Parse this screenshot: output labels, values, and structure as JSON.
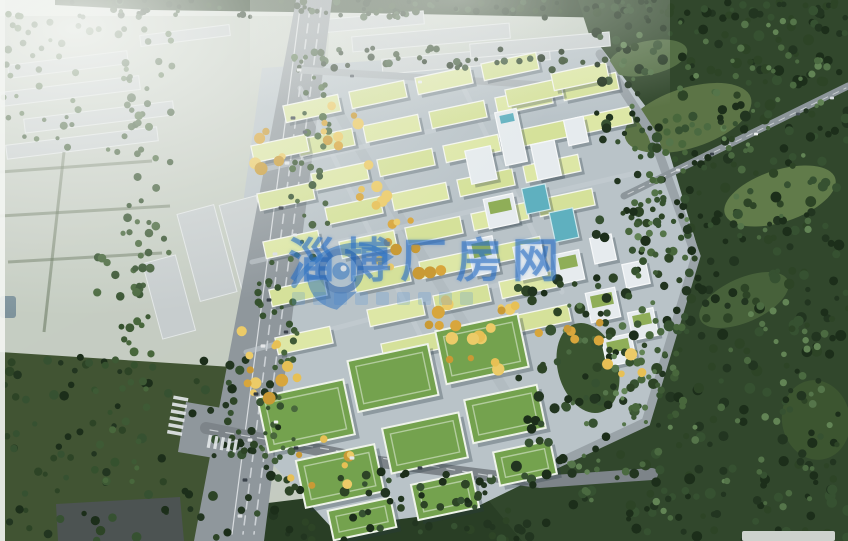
{
  "image": {
    "description": "Aerial bird's-eye rendering of an eco industrial park: rows of white multi-storey factory buildings with pale yellow-green and grass-green roofs, a tree-lined highway on the left, grey factory sheds and hazy fields at the top-left, and dense dark forest on the right and bottom, with a central avenue of autumn-yellow trees.",
    "width": 848,
    "height": 541
  },
  "watermark": {
    "text": "淄博厂房网",
    "tagline_blocks": 9,
    "text_color": "rgba(40,110,195,0.55)",
    "logo": "aperture-swoosh-icon",
    "logo_color": "#2a6fc0"
  },
  "palette": {
    "haze_white": "#f4f6f3",
    "field_grey_green": "#c5ccc2",
    "forest_dark": "#31472c",
    "lawn_dark": "#415433",
    "park_ground": "#b9c3c8",
    "pale_roof": "#dde7a6",
    "green_roof": "#74a24e",
    "road_grey": "#8f979c",
    "teal_glass": "#5fb0bf",
    "autumn_yellow": "#e7c055",
    "watermark_blue": "#2a6fc0"
  },
  "scene": {
    "shadow": "rgba(40,55,65,0.30)",
    "palettes": {
      "dark": [
        "#223520",
        "#2d4426",
        "#365131",
        "#1c2e1a"
      ],
      "mid": [
        "#3e5a35",
        "#48673c",
        "#35512e"
      ],
      "light": [
        "#55754a",
        "#628455",
        "#4b6a41"
      ],
      "yellow": [
        "#d8a63c",
        "#e7c055",
        "#c99a35",
        "#eccb68"
      ]
    },
    "polygons": [
      {
        "name": "fields-top-left",
        "pts": "0,16 330,16 304,541 0,541",
        "fill": "#c5ccc2",
        "op": 0.95
      },
      {
        "name": "top-tree-strip",
        "pts": "55,0 848,0 848,13 620,18 360,13 150,10 55,5",
        "fill": "#2b3f27",
        "op": 1
      },
      {
        "name": "lawn-bottom-left",
        "pts": "0,352 248,368 258,541 0,541",
        "fill": "#415433",
        "op": 1
      },
      {
        "name": "dark-building-bottom-left",
        "pts": "56,504 180,497 184,541 58,541",
        "fill": "#4c5352",
        "op": 1
      },
      {
        "name": "forest-right",
        "pts": "578,0 848,0 848,541 514,541 468,502 556,458 640,422 698,256 648,146 596,56",
        "fill": "#31472c",
        "op": 1
      },
      {
        "name": "forest-bottom",
        "pts": "244,506 470,478 522,541 244,541",
        "fill": "#293e25",
        "op": 1
      },
      {
        "name": "park-ground",
        "pts": "262,68 600,46 662,128 700,256 646,424 556,468 470,510 332,528 252,442 244,196",
        "fill": "#b9c3c8",
        "op": 1
      }
    ],
    "clearings": [
      [
        688,
        118,
        66,
        30,
        -18,
        "#5c7446"
      ],
      [
        780,
        196,
        58,
        26,
        -18,
        "#617b4a"
      ],
      [
        648,
        58,
        40,
        17,
        -12,
        "#546e45"
      ],
      [
        744,
        300,
        48,
        22,
        -24,
        "#47613a"
      ],
      [
        816,
        420,
        34,
        40,
        -10,
        "#3c5530"
      ],
      [
        588,
        368,
        30,
        46,
        -16,
        "#3a5430"
      ]
    ],
    "sheds": {
      "fill": "#c7cdce",
      "stroke": "#e3e7e7",
      "items": [
        [
          8,
          58,
          120,
          13,
          -7
        ],
        [
          0,
          84,
          140,
          14,
          -7
        ],
        [
          24,
          110,
          150,
          14,
          -7
        ],
        [
          6,
          136,
          152,
          14,
          -7
        ],
        [
          140,
          30,
          90,
          11,
          -7
        ],
        [
          188,
          208,
          38,
          90,
          -15
        ],
        [
          230,
          199,
          38,
          88,
          -15
        ],
        [
          152,
          258,
          34,
          78,
          -15
        ],
        [
          306,
          16,
          118,
          13,
          -5
        ],
        [
          352,
          30,
          158,
          15,
          -5
        ],
        [
          382,
          52,
          168,
          15,
          -5
        ],
        [
          470,
          38,
          140,
          14,
          -5
        ]
      ]
    },
    "hedge_color": "#5e6e54",
    "hedges": [
      "M0,172 L152,161",
      "M0,216 L170,206",
      "M8,262 L162,253",
      "M64,152 L44,332"
    ],
    "pond": {
      "x": 0,
      "y": 296,
      "w": 16,
      "h": 22,
      "fill": "#7e939c"
    },
    "roads": [
      {
        "name": "highway",
        "pts": "296,0 332,0 264,541 194,541",
        "fill": "#8f979c"
      },
      {
        "name": "intersection-pad",
        "pts": "186,402 246,412 238,462 178,452",
        "fill": "#8f979c"
      },
      {
        "name": "highway-lane-line-1",
        "d": "M310,8 L243,534",
        "w": 1.6,
        "color": "#ccd1d5",
        "dash": "9 7"
      },
      {
        "name": "highway-lane-line-2",
        "d": "M321,8 L254,534",
        "w": 1.6,
        "color": "#ccd1d5",
        "dash": "9 7"
      },
      {
        "name": "highway-edge-line",
        "d": "M300,8 L232,534",
        "w": 1.2,
        "color": "#d8dcdf",
        "dash": ""
      },
      {
        "name": "park-top-road",
        "d": "M300,70 L622,90",
        "w": 7,
        "color": "#a9b1b5",
        "dash": ""
      },
      {
        "name": "park-perimeter-road",
        "d": "M600,54 L652,134 L696,256 L646,422 L556,464",
        "w": 9,
        "color": "#9aa3a8",
        "dash": ""
      },
      {
        "name": "bottom-road",
        "d": "M206,428 L380,462 L540,482 L652,474",
        "w": 12,
        "color": "#7d8489",
        "dash": ""
      },
      {
        "name": "bottom-road-line",
        "d": "M210,430 L540,484",
        "w": 1.2,
        "color": "#c5cacd",
        "dash": "8 8"
      },
      {
        "name": "forest-road",
        "d": "M624,196 L848,86",
        "w": 7,
        "color": "#8d969b",
        "dash": ""
      },
      {
        "name": "forest-road-line",
        "d": "M628,194 L846,88",
        "w": 1,
        "color": "#c8cdd0",
        "dash": "6 6"
      },
      {
        "name": "central-avenue",
        "d": "M330,98 L420,252 L468,330 L512,402",
        "w": 10,
        "color": "#b2bcc1",
        "dash": ""
      }
    ],
    "street_lines": {
      "color": "#c6ced3",
      "w": 5,
      "op": 0.55,
      "d": [
        "M262,170 L600,92",
        "M252,262 L640,172",
        "M246,352 L562,268",
        "M300,88 L438,372",
        "M452,64 L562,292"
      ]
    },
    "park_rows": {
      "w": 56,
      "h": 17,
      "rot": -12,
      "fill": "#dde7a6",
      "fill_alt": "#d5e19a",
      "stroke": "#f4f6ef",
      "rows": [
        {
          "x": 284,
          "y": 100,
          "n": 4,
          "dx": 66,
          "dy": -14
        },
        {
          "x": 298,
          "y": 134,
          "n": 5,
          "dx": 66,
          "dy": -14
        },
        {
          "x": 312,
          "y": 168,
          "n": 5,
          "dx": 66,
          "dy": -14
        },
        {
          "x": 326,
          "y": 202,
          "n": 4,
          "dx": 66,
          "dy": -14
        },
        {
          "x": 340,
          "y": 236,
          "n": 4,
          "dx": 66,
          "dy": -14
        },
        {
          "x": 354,
          "y": 270,
          "n": 3,
          "dx": 66,
          "dy": -14
        },
        {
          "x": 368,
          "y": 304,
          "n": 3,
          "dx": 66,
          "dy": -14
        },
        {
          "x": 382,
          "y": 338,
          "n": 3,
          "dx": 66,
          "dy": -14
        },
        {
          "x": 252,
          "y": 140,
          "n": 1
        },
        {
          "x": 258,
          "y": 188,
          "n": 1
        },
        {
          "x": 264,
          "y": 236,
          "n": 1
        },
        {
          "x": 270,
          "y": 284,
          "n": 1
        },
        {
          "x": 276,
          "y": 332,
          "n": 1
        },
        {
          "x": 506,
          "y": 84,
          "n": 1
        },
        {
          "x": 552,
          "y": 68,
          "n": 1
        }
      ]
    },
    "mid_buildings": {
      "rot": -12,
      "body": "#e6ebee",
      "stroke": "#f6f8f9",
      "cap": "#8fae58",
      "teal": "#5fb0bf",
      "teal_stroke": "#cfe8ec",
      "items": [
        [
          500,
          110,
          22,
          54,
          "tower"
        ],
        [
          468,
          148,
          26,
          34,
          "plain"
        ],
        [
          534,
          142,
          24,
          36,
          "plain"
        ],
        [
          566,
          118,
          20,
          26,
          "plain"
        ],
        [
          486,
          196,
          30,
          30,
          "cap"
        ],
        [
          524,
          186,
          24,
          26,
          "teal"
        ],
        [
          552,
          210,
          24,
          30,
          "teal"
        ],
        [
          470,
          238,
          26,
          36,
          "cap"
        ],
        [
          516,
          244,
          28,
          34,
          "plain"
        ],
        [
          556,
          252,
          26,
          30,
          "cap"
        ],
        [
          592,
          236,
          22,
          26,
          "plain"
        ],
        [
          588,
          290,
          30,
          30,
          "cap"
        ],
        [
          624,
          262,
          24,
          24,
          "plain"
        ],
        [
          630,
          310,
          26,
          28,
          "cap"
        ],
        [
          604,
          336,
          30,
          28,
          "cap"
        ]
      ]
    },
    "lower_buildings": {
      "rot": -12,
      "roof": "#74a24e",
      "stroke": "#eef3ea",
      "items": [
        [
          262,
          388,
          88,
          56
        ],
        [
          352,
          352,
          82,
          52
        ],
        [
          440,
          322,
          84,
          54
        ],
        [
          300,
          452,
          80,
          48
        ],
        [
          386,
          420,
          78,
          46
        ],
        [
          468,
          392,
          74,
          44
        ],
        [
          330,
          504,
          64,
          30
        ],
        [
          414,
          478,
          62,
          36
        ],
        [
          496,
          446,
          58,
          34
        ]
      ]
    },
    "tree_patches": [
      {
        "x": 70,
        "y": 0,
        "w": 778,
        "h": 18,
        "n": 110,
        "pal": "dark",
        "rmin": 2,
        "rmax": 4,
        "seed": 11
      },
      {
        "x": 596,
        "y": 0,
        "w": 252,
        "h": 262,
        "n": 230,
        "pal": "dark",
        "rmin": 2.5,
        "rmax": 5.5,
        "seed": 22
      },
      {
        "x": 620,
        "y": 20,
        "w": 210,
        "h": 220,
        "n": 70,
        "pal": "light",
        "rmin": 2,
        "rmax": 4,
        "seed": 23
      },
      {
        "x": 516,
        "y": 268,
        "w": 332,
        "h": 272,
        "n": 260,
        "pal": "dark",
        "rmin": 2.5,
        "rmax": 5.5,
        "seed": 33
      },
      {
        "x": 560,
        "y": 300,
        "w": 270,
        "h": 220,
        "n": 80,
        "pal": "light",
        "rmin": 2,
        "rmax": 4,
        "seed": 34
      },
      {
        "x": 246,
        "y": 470,
        "w": 280,
        "h": 70,
        "n": 70,
        "pal": "dark",
        "rmin": 2.5,
        "rmax": 5,
        "seed": 44
      },
      {
        "x": 0,
        "y": 356,
        "w": 252,
        "h": 185,
        "n": 90,
        "pal": "dark",
        "rmin": 2.5,
        "rmax": 5,
        "seed": 55
      },
      {
        "x": 116,
        "y": 28,
        "w": 56,
        "h": 225,
        "n": 48,
        "pal": "mid",
        "rmin": 2.5,
        "rmax": 4.5,
        "seed": 66
      },
      {
        "x": 94,
        "y": 255,
        "w": 58,
        "h": 230,
        "n": 48,
        "pal": "mid",
        "rmin": 2.5,
        "rmax": 4.5,
        "seed": 67
      },
      {
        "x": 290,
        "y": 55,
        "w": 40,
        "h": 205,
        "n": 34,
        "pal": "mid",
        "rmin": 2,
        "rmax": 4,
        "seed": 68
      },
      {
        "x": 256,
        "y": 262,
        "w": 42,
        "h": 200,
        "n": 36,
        "pal": "mid",
        "rmin": 2,
        "rmax": 4,
        "seed": 69
      },
      {
        "x": 296,
        "y": 48,
        "w": 330,
        "h": 24,
        "n": 44,
        "pal": "dark",
        "rmin": 2,
        "rmax": 4,
        "seed": 77
      },
      {
        "x": 628,
        "y": 118,
        "w": 58,
        "h": 305,
        "n": 60,
        "pal": "mid",
        "rmin": 2.5,
        "rmax": 4.5,
        "seed": 88
      },
      {
        "x": 214,
        "y": 378,
        "w": 66,
        "h": 95,
        "n": 22,
        "pal": "dark",
        "rmin": 2.5,
        "rmax": 4.5,
        "seed": 99
      },
      {
        "x": 0,
        "y": 14,
        "w": 120,
        "h": 140,
        "n": 40,
        "pal": "mid",
        "rmin": 2,
        "rmax": 4,
        "seed": 12
      }
    ],
    "yellow_patches": [
      {
        "x": 322,
        "y": 102,
        "w": 42,
        "h": 50,
        "n": 8,
        "seed": 101
      },
      {
        "x": 348,
        "y": 156,
        "w": 42,
        "h": 56,
        "n": 8,
        "seed": 102
      },
      {
        "x": 378,
        "y": 212,
        "w": 44,
        "h": 58,
        "n": 8,
        "seed": 103
      },
      {
        "x": 410,
        "y": 270,
        "w": 46,
        "h": 58,
        "n": 9,
        "seed": 104
      },
      {
        "x": 444,
        "y": 324,
        "w": 60,
        "h": 46,
        "n": 8,
        "seed": 105
      },
      {
        "x": 240,
        "y": 318,
        "w": 64,
        "h": 114,
        "n": 12,
        "seed": 106
      },
      {
        "x": 290,
        "y": 434,
        "w": 62,
        "h": 62,
        "n": 8,
        "seed": 107
      },
      {
        "x": 486,
        "y": 294,
        "w": 56,
        "h": 42,
        "n": 6,
        "seed": 108
      },
      {
        "x": 556,
        "y": 316,
        "w": 46,
        "h": 30,
        "n": 5,
        "seed": 109
      },
      {
        "x": 250,
        "y": 114,
        "w": 40,
        "h": 64,
        "n": 6,
        "seed": 110
      },
      {
        "x": 600,
        "y": 348,
        "w": 42,
        "h": 32,
        "n": 5,
        "seed": 111
      }
    ],
    "cars": [
      [
        299,
        70,
        2.4,
        "#e2e5e7"
      ],
      [
        293,
        118,
        2.4,
        "#3a424a"
      ],
      [
        287,
        163,
        2.4,
        "#e2e5e7"
      ],
      [
        281,
        208,
        2.4,
        "#2f373e"
      ],
      [
        275,
        254,
        2.4,
        "#d9dde0"
      ],
      [
        269,
        300,
        2.4,
        "#3a424a"
      ],
      [
        263,
        346,
        2.4,
        "#e5e7e9"
      ],
      [
        256,
        394,
        2.4,
        "#323a40"
      ],
      [
        250,
        440,
        2.4,
        "#e2e5e7"
      ],
      [
        245,
        480,
        2.4,
        "#3a424a"
      ],
      [
        240,
        516,
        2.4,
        "#d9dde0"
      ],
      [
        305,
        132,
        2.2,
        "#4a535b"
      ],
      [
        295,
        235,
        2.2,
        "#eceeef"
      ],
      [
        286,
        332,
        2.2,
        "#3a424a"
      ],
      [
        276,
        422,
        2.2,
        "#eceeef"
      ],
      [
        678,
        170,
        2,
        "#d9dde0"
      ],
      [
        712,
        154,
        2,
        "#3a424a"
      ],
      [
        756,
        134,
        2,
        "#eceeef"
      ],
      [
        798,
        114,
        2,
        "#4a535b"
      ],
      [
        832,
        98,
        2,
        "#d9dde0"
      ],
      [
        296,
        448,
        2.4,
        "#323a40"
      ],
      [
        352,
        458,
        2.4,
        "#e5e7e9"
      ],
      [
        420,
        468,
        2.4,
        "#3a424a"
      ],
      [
        490,
        476,
        2.4,
        "#d9dde0"
      ],
      [
        352,
        76,
        2,
        "#4a535b"
      ],
      [
        420,
        82,
        2,
        "#eceeef"
      ]
    ],
    "crosswalks": [
      {
        "x": 178,
        "y": 414,
        "rot": -80,
        "n": 6,
        "len": 15,
        "sw": 3.5,
        "gap": 3.5
      },
      {
        "x": 224,
        "y": 444,
        "rot": 10,
        "n": 5,
        "len": 13,
        "sw": 3.2,
        "gap": 3.4
      }
    ],
    "left_strip": {
      "w": 5,
      "fill": "#f3f5f2"
    },
    "corner_sliver": {
      "x": 742,
      "y": 531,
      "w": 93,
      "h": 10,
      "fill": "#cdd2cd"
    }
  }
}
